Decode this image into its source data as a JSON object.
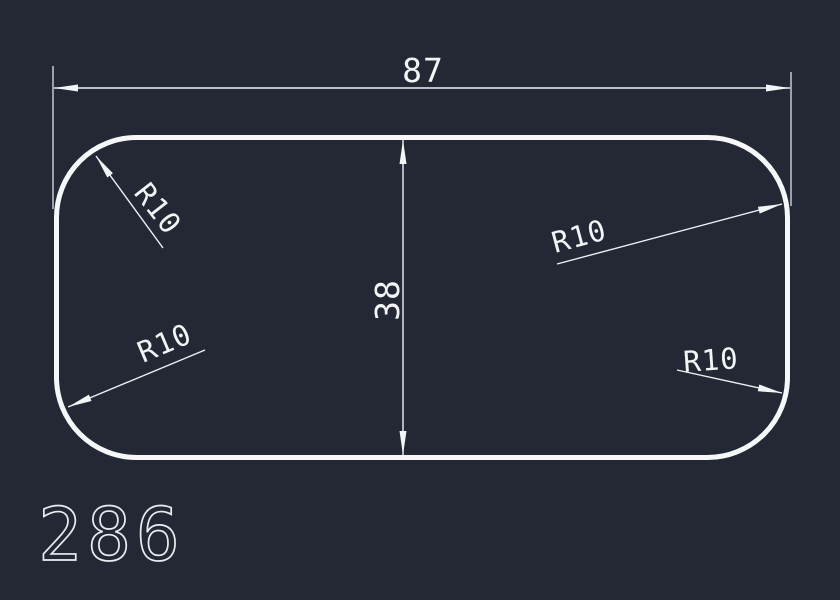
{
  "canvas": {
    "background_color": "#232834",
    "line_color": "#f2f4f6"
  },
  "part": {
    "shape": "rounded-rectangle",
    "width": 87,
    "height": 38,
    "corner_radius": 10
  },
  "dimensions": {
    "width": {
      "label": "87"
    },
    "height": {
      "label": "38"
    },
    "radius_callouts": [
      {
        "position": "top-left",
        "label": "R10"
      },
      {
        "position": "top-right",
        "label": "R10"
      },
      {
        "position": "bottom-left",
        "label": "R10"
      },
      {
        "position": "bottom-right",
        "label": "R10"
      }
    ]
  },
  "footer": {
    "drawing_number": "286"
  }
}
